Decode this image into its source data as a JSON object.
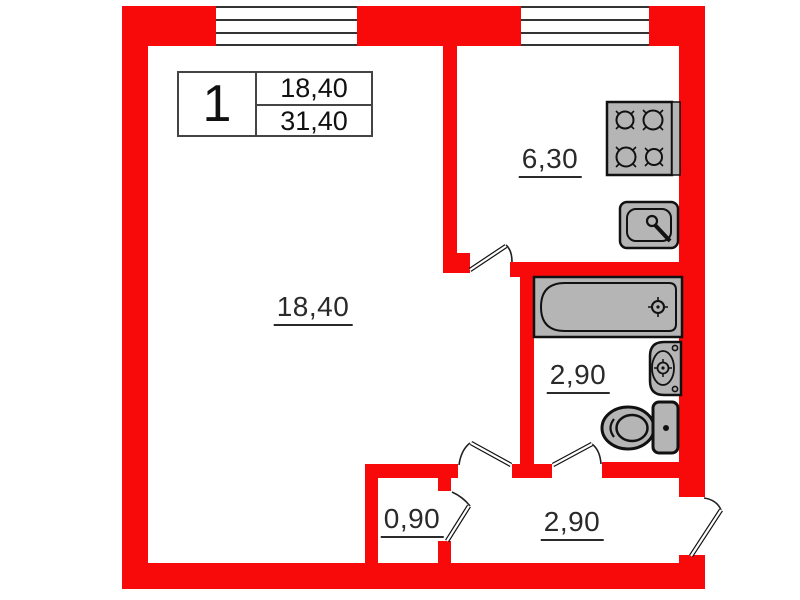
{
  "title": "apartment-floor-plan",
  "colors": {
    "wall": "#f90a0a",
    "fixture_fill": "#b5b5b5",
    "outline": "#111111",
    "text": "#2a2a2a"
  },
  "legend": {
    "unit_number": "1",
    "living_area": "18,40",
    "total_area": "31,40"
  },
  "rooms": {
    "living": {
      "area": "18,40"
    },
    "kitchen": {
      "area": "6,30"
    },
    "bathroom": {
      "area": "2,90"
    },
    "hallway": {
      "area": "2,90"
    },
    "closet": {
      "area": "0,90"
    }
  },
  "fixtures": [
    "stove",
    "kitchen-sink",
    "bathtub",
    "washbasin",
    "toilet"
  ],
  "doors": [
    "kitchen-door",
    "living-hall-door",
    "bathroom-door",
    "closet-door",
    "entrance-door"
  ],
  "windows": [
    "living-room-window",
    "kitchen-window"
  ]
}
